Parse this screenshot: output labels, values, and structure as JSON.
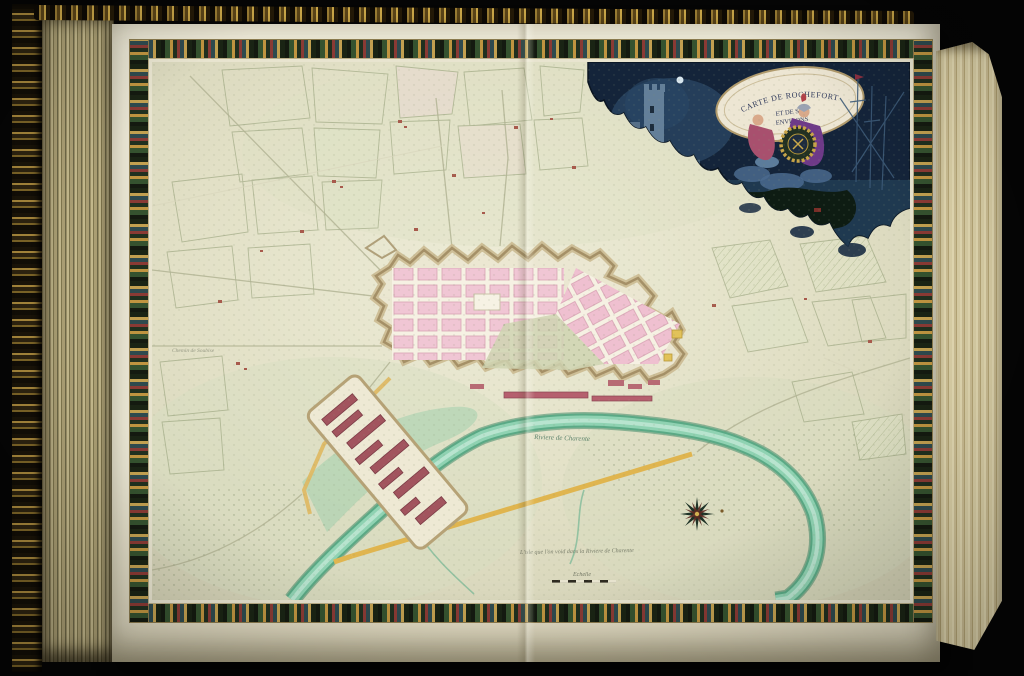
{
  "artwork": {
    "cartouche": {
      "line1": "CARTE DE ROCHEFORT",
      "line2": "ET DE SES",
      "line3": "ENVIRONS"
    },
    "map_labels": {
      "river": "Riviere de Charente",
      "annotation": "L'isle que l'on void dans la Riviere de Charente",
      "left_note": "Chemin de Soubise",
      "scale_label": "Echelle"
    },
    "palette": {
      "paper": "#e3e1c9",
      "city_block_pink": "#f0c6d4",
      "river_teal": "#7ec8a8",
      "road_gold": "#e0b54f",
      "frame_dark_green": "#232d1e",
      "cartouche_navy": "#14243a",
      "gilt_edge_gold": "#a8883c"
    }
  }
}
